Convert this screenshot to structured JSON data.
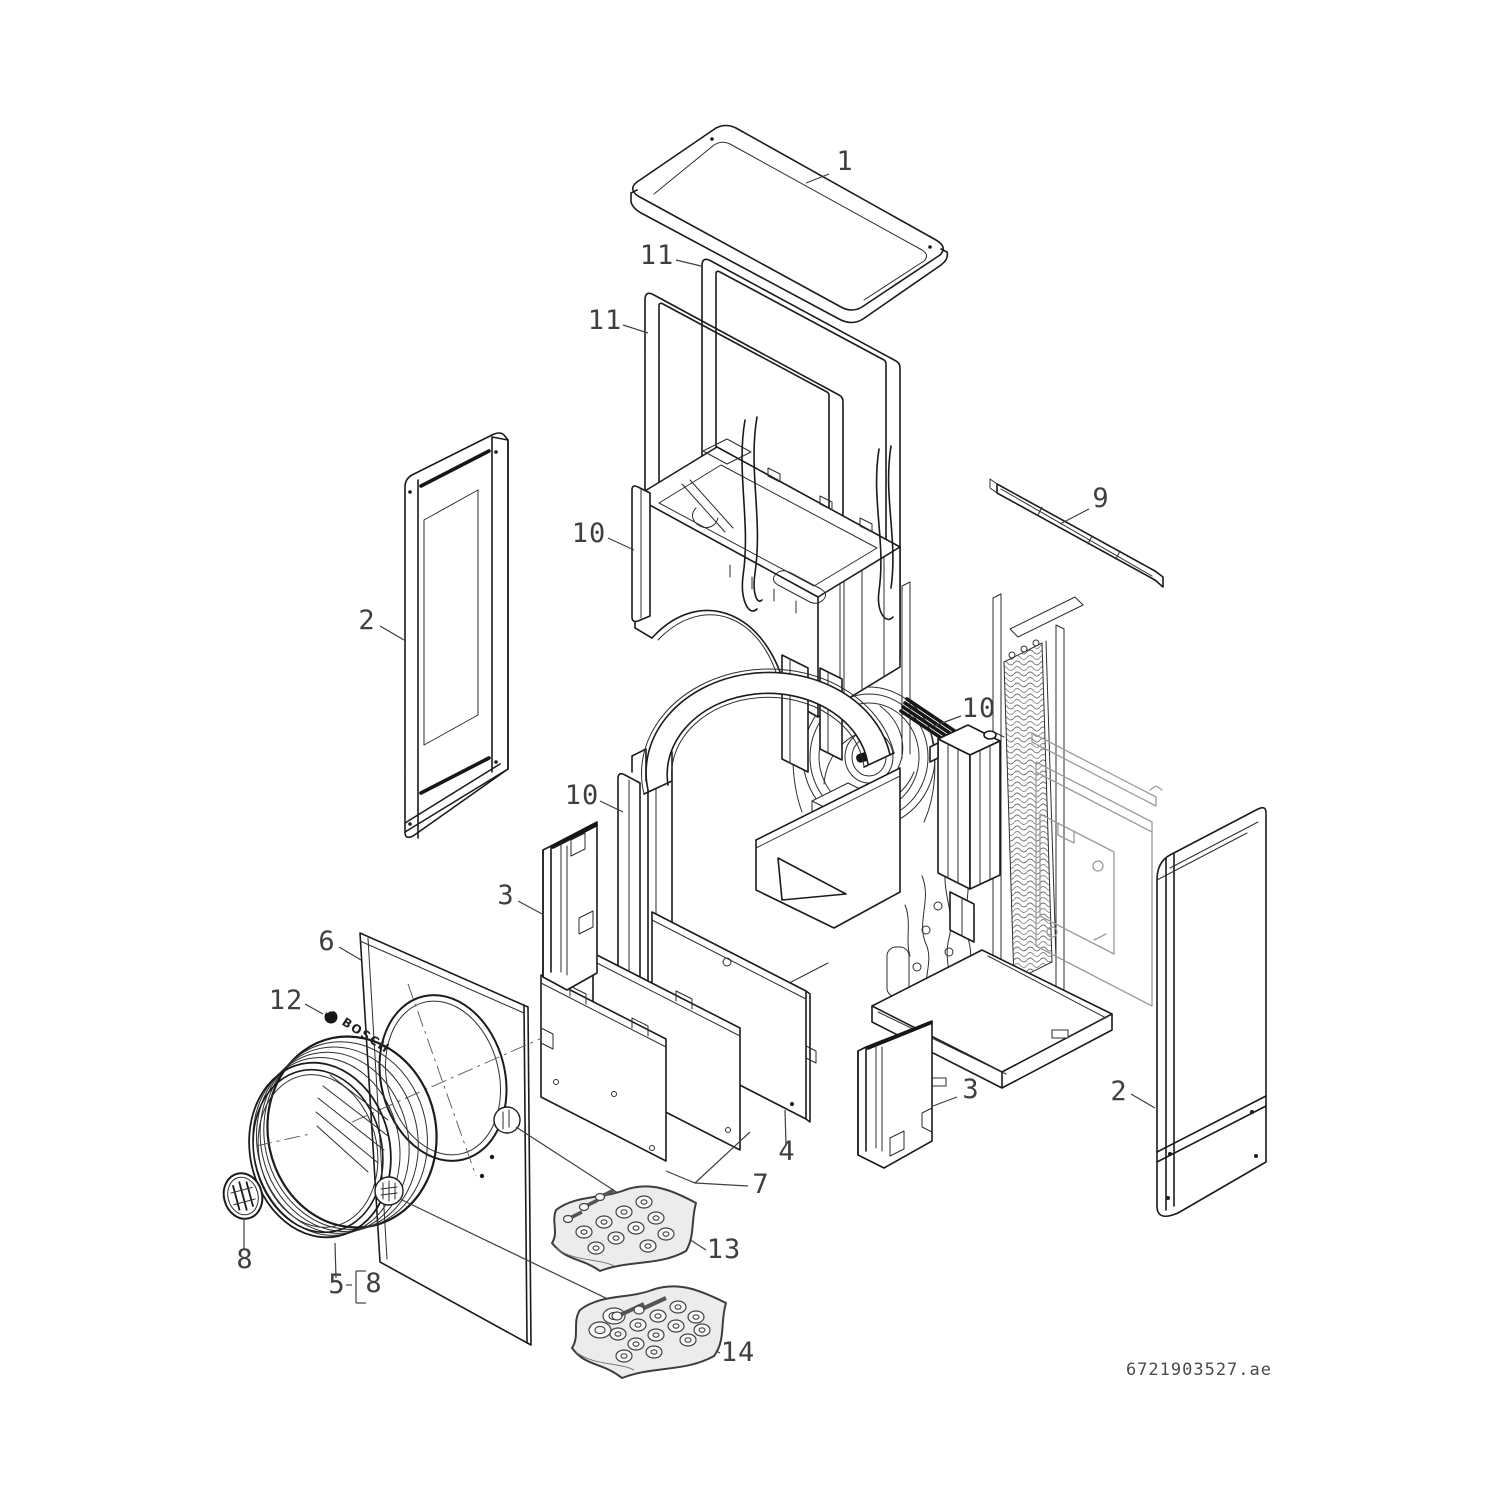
{
  "document": {
    "code": "6721903527.ae"
  },
  "brand": {
    "wordmark": "BOSCH",
    "roundel": "bosch-anchor-roundel"
  },
  "colors": {
    "line": "#1b1b1b",
    "light_line": "#9b9b9b",
    "sheet_fill": "#ececec",
    "background": "#ffffff"
  },
  "diagram": {
    "type": "exploded-parts-diagram",
    "part_numbers_visible": [
      "1",
      "2",
      "3",
      "4",
      "5",
      "6",
      "7",
      "8",
      "9",
      "10",
      "11",
      "12",
      "13",
      "14"
    ],
    "callouts": [
      {
        "text": "1",
        "x": 845,
        "y": 170,
        "leader": [
          [
            829,
            174
          ],
          [
            806,
            183
          ]
        ]
      },
      {
        "text": "11",
        "x": 657,
        "y": 264,
        "leader": [
          [
            676,
            260
          ],
          [
            701,
            266
          ]
        ]
      },
      {
        "text": "11",
        "x": 605,
        "y": 329,
        "leader": [
          [
            623,
            325
          ],
          [
            648,
            333
          ]
        ]
      },
      {
        "text": "2",
        "x": 367,
        "y": 629,
        "leader": [
          [
            380,
            626
          ],
          [
            404,
            640
          ]
        ]
      },
      {
        "text": "10",
        "x": 589,
        "y": 542,
        "leader": [
          [
            608,
            538
          ],
          [
            634,
            550
          ]
        ]
      },
      {
        "text": "9",
        "x": 1101,
        "y": 507,
        "leader": [
          [
            1089,
            509
          ],
          [
            1060,
            524
          ]
        ]
      },
      {
        "text": "10",
        "x": 979,
        "y": 717,
        "leader": [
          [
            961,
            716
          ],
          [
            934,
            726
          ]
        ]
      },
      {
        "text": "10",
        "x": 582,
        "y": 804,
        "leader": [
          [
            600,
            801
          ],
          [
            623,
            812
          ]
        ]
      },
      {
        "text": "3",
        "x": 506,
        "y": 904,
        "leader": [
          [
            518,
            901
          ],
          [
            544,
            915
          ]
        ]
      },
      {
        "text": "6",
        "x": 327,
        "y": 950,
        "leader": [
          [
            339,
            947
          ],
          [
            361,
            960
          ]
        ]
      },
      {
        "text": "12",
        "x": 286,
        "y": 1009,
        "leader": [
          [
            305,
            1004
          ],
          [
            323,
            1014
          ]
        ]
      },
      {
        "text": "4",
        "x": 787,
        "y": 1160,
        "leader": [
          [
            786,
            1146
          ],
          [
            785,
            1110
          ]
        ]
      },
      {
        "text": "7",
        "x": 761,
        "y": 1193,
        "leader": [
          [
            748,
            1186
          ],
          [
            695,
            1183
          ],
          [
            666,
            1171
          ]
        ]
      },
      {
        "text": "3",
        "x": 971,
        "y": 1098,
        "leader": [
          [
            957,
            1097
          ],
          [
            933,
            1106
          ]
        ]
      },
      {
        "text": "2",
        "x": 1119,
        "y": 1100,
        "leader": [
          [
            1131,
            1094
          ],
          [
            1155,
            1108
          ]
        ]
      },
      {
        "text": "8",
        "x": 245,
        "y": 1268,
        "leader": [
          [
            244,
            1250
          ],
          [
            244,
            1220
          ]
        ]
      },
      {
        "text": "5",
        "x": 337,
        "y": 1293,
        "leader": [
          [
            336,
            1278
          ],
          [
            335,
            1243
          ]
        ]
      },
      {
        "text": "8",
        "x": 374,
        "y": 1292,
        "leader": []
      },
      {
        "text": "13",
        "x": 724,
        "y": 1258,
        "leader": [
          [
            706,
            1250
          ],
          [
            516,
            1127
          ]
        ]
      },
      {
        "text": "14",
        "x": 738,
        "y": 1361,
        "leader": [
          [
            720,
            1353
          ],
          [
            400,
            1199
          ]
        ]
      }
    ],
    "annotation_lines": [
      [
        [
          346,
          1285
        ],
        [
          352,
          1285
        ]
      ],
      [
        [
          356,
          1271
        ],
        [
          356,
          1303
        ]
      ],
      [
        [
          356,
          1271
        ],
        [
          366,
          1271
        ]
      ],
      [
        [
          356,
          1303
        ],
        [
          366,
          1303
        ]
      ],
      [
        [
          695,
          1183
        ],
        [
          750,
          1132
        ]
      ]
    ]
  }
}
